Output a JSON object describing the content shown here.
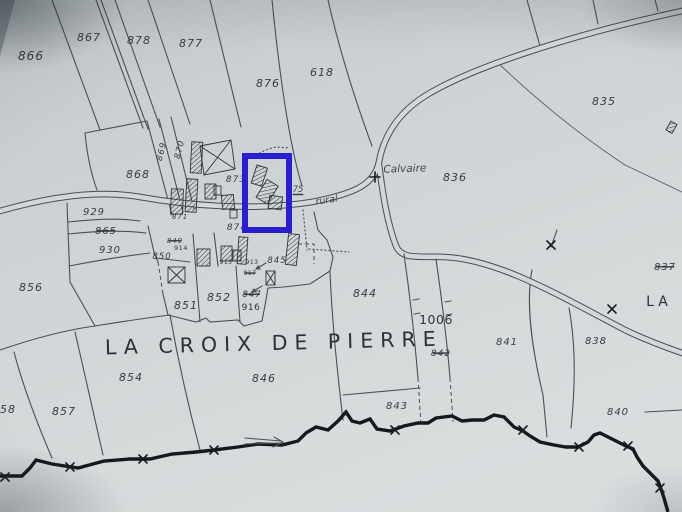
{
  "map": {
    "title": "LA CROIX DE PIERRE",
    "secondary_place_fragment": "LA",
    "landmark": "Calvaire",
    "road_labels": [
      "75",
      "rural"
    ],
    "colors": {
      "paper": "#d0d5d7",
      "ink": "#454b52",
      "stream": "#16181b",
      "highlight": "#2a1fd0"
    },
    "highlight_box": {
      "x": 245,
      "y": 156,
      "width": 44,
      "height": 74
    },
    "labels": [
      {
        "t": "866",
        "x": 31,
        "y": 60,
        "s": 12,
        "cls": "old"
      },
      {
        "t": "867",
        "x": 89,
        "y": 41,
        "s": 11,
        "cls": "old"
      },
      {
        "t": "878",
        "x": 139,
        "y": 44,
        "s": 11,
        "cls": "old"
      },
      {
        "t": "877",
        "x": 191,
        "y": 47,
        "s": 11,
        "cls": "old"
      },
      {
        "t": "876",
        "x": 268,
        "y": 87,
        "s": 11,
        "cls": "old"
      },
      {
        "t": "618",
        "x": 322,
        "y": 76,
        "s": 11,
        "cls": "old"
      },
      {
        "t": "835",
        "x": 604,
        "y": 105,
        "s": 11,
        "cls": "old"
      },
      {
        "t": "868",
        "x": 138,
        "y": 178,
        "s": 11,
        "cls": "old"
      },
      {
        "t": "869",
        "x": 164,
        "y": 152,
        "s": 8.5,
        "r": -76,
        "cls": "old"
      },
      {
        "t": "870",
        "x": 182,
        "y": 150,
        "s": 8.5,
        "r": -76,
        "cls": "old"
      },
      {
        "t": "873",
        "x": 236,
        "y": 182,
        "s": 9,
        "cls": "old"
      },
      {
        "t": "871",
        "x": 180,
        "y": 219,
        "s": 7,
        "cls": "old"
      },
      {
        "t": "874",
        "x": 237,
        "y": 230,
        "s": 9,
        "cls": "old"
      },
      {
        "t": "929",
        "x": 94,
        "y": 215,
        "s": 10,
        "cls": "old"
      },
      {
        "t": "865",
        "x": 106,
        "y": 234,
        "s": 10,
        "cls": "old",
        "struck": true
      },
      {
        "t": "930",
        "x": 110,
        "y": 253,
        "s": 10,
        "cls": "old"
      },
      {
        "t": "856",
        "x": 31,
        "y": 291,
        "s": 11,
        "cls": "old"
      },
      {
        "t": "849",
        "x": 175,
        "y": 243,
        "s": 7,
        "cls": "old",
        "struck": true
      },
      {
        "t": "914",
        "x": 181,
        "y": 250,
        "s": 6.5,
        "cls": "new"
      },
      {
        "t": "850",
        "x": 162,
        "y": 259,
        "s": 8.5,
        "cls": "old"
      },
      {
        "t": "915",
        "x": 226,
        "y": 264,
        "s": 6,
        "cls": "new"
      },
      {
        "t": "913",
        "x": 252,
        "y": 264,
        "s": 6,
        "cls": "new"
      },
      {
        "t": "917",
        "x": 250,
        "y": 275,
        "s": 6,
        "cls": "new",
        "struck": true
      },
      {
        "t": "845",
        "x": 277,
        "y": 263,
        "s": 8.5,
        "cls": "old"
      },
      {
        "t": "851",
        "x": 186,
        "y": 309,
        "s": 11,
        "cls": "old"
      },
      {
        "t": "852",
        "x": 219,
        "y": 301,
        "s": 11,
        "cls": "old"
      },
      {
        "t": "847",
        "x": 252,
        "y": 297,
        "s": 8.5,
        "cls": "old",
        "struck": true
      },
      {
        "t": "916",
        "x": 251,
        "y": 310,
        "s": 9,
        "cls": "new"
      },
      {
        "t": "844",
        "x": 365,
        "y": 297,
        "s": 11,
        "cls": "old"
      },
      {
        "t": "1006",
        "x": 436,
        "y": 324,
        "s": 12.5,
        "cls": "new"
      },
      {
        "t": "842",
        "x": 441,
        "y": 356,
        "s": 9,
        "cls": "old",
        "struck": true
      },
      {
        "t": "841",
        "x": 507,
        "y": 345,
        "s": 10,
        "cls": "old"
      },
      {
        "t": "838",
        "x": 596,
        "y": 344,
        "s": 10,
        "cls": "old"
      },
      {
        "t": "837",
        "x": 665,
        "y": 270,
        "s": 10,
        "cls": "old",
        "struck": true
      },
      {
        "t": "836",
        "x": 455,
        "y": 181,
        "s": 11,
        "cls": "old"
      },
      {
        "t": "840",
        "x": 618,
        "y": 415,
        "s": 10,
        "cls": "old"
      },
      {
        "t": "843",
        "x": 397,
        "y": 409,
        "s": 10,
        "cls": "old"
      },
      {
        "t": "846",
        "x": 264,
        "y": 382,
        "s": 11,
        "cls": "old"
      },
      {
        "t": "854",
        "x": 131,
        "y": 381,
        "s": 11,
        "cls": "old"
      },
      {
        "t": "857",
        "x": 64,
        "y": 415,
        "s": 11,
        "cls": "old"
      },
      {
        "t": "58",
        "x": 8,
        "y": 413,
        "s": 11,
        "cls": "old"
      },
      {
        "t": "75",
        "x": 298,
        "y": 192,
        "s": 8.5,
        "cls": "script",
        "underline": true
      },
      {
        "t": "rural",
        "x": 327,
        "y": 203,
        "s": 9.5,
        "r": -9,
        "cls": "script"
      },
      {
        "t": "Calvaire",
        "x": 405,
        "y": 172,
        "s": 10.5,
        "r": -2,
        "cls": "script"
      },
      {
        "t": "LA CROIX DE PIERRE",
        "x": 274,
        "y": 350,
        "s": 20.5,
        "ls": 7,
        "r": -1.5,
        "cls": "big"
      },
      {
        "t": "LA",
        "x": 659,
        "y": 306,
        "s": 14,
        "ls": 4,
        "cls": "big"
      }
    ]
  }
}
